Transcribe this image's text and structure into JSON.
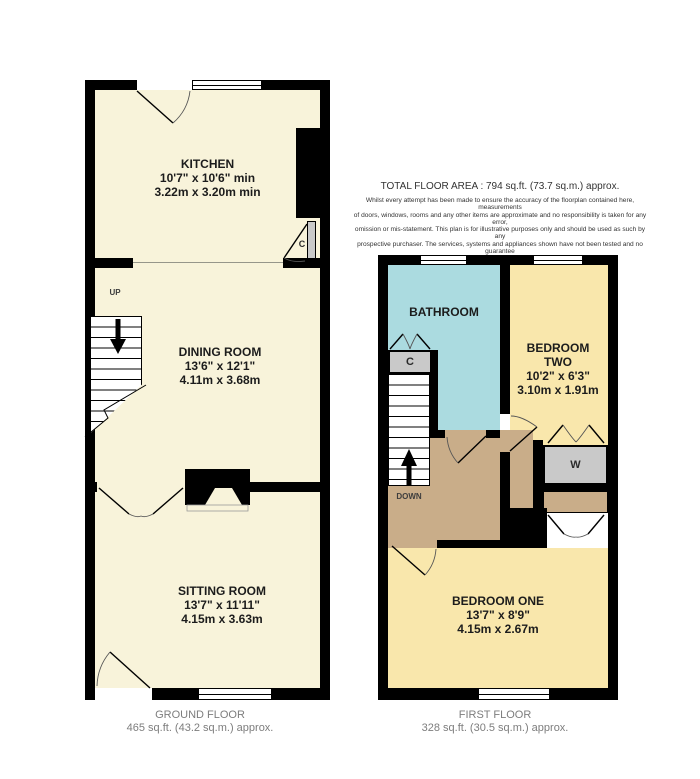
{
  "header": {
    "total_area": "TOTAL FLOOR AREA : 794 sq.ft. (73.7 sq.m.) approx.",
    "disclaimer_lines": [
      "Whilst every attempt has been made to ensure the accuracy of the floorplan contained here, measurements",
      "of doors, windows, rooms and any other items are approximate and no responsibility is taken for any error,",
      "omission or mis-statement. This plan is for illustrative purposes only and should be used as such by any",
      "prospective purchaser. The services, systems and appliances shown have not been tested and no guarantee",
      "as to their operability or efficiency can be given."
    ],
    "credit": "Made with Metropix ©2026"
  },
  "ground_floor": {
    "floor_label": "GROUND FLOOR",
    "floor_area": "465 sq.ft. (43.2 sq.m.) approx.",
    "stairs_direction": "UP",
    "cupboard": "C",
    "rooms": {
      "kitchen": {
        "name": "KITCHEN",
        "imperial": "10'7\"  x 10'6\" min",
        "metric": "3.22m  x 3.20m min"
      },
      "dining": {
        "name": "DINING ROOM",
        "imperial": "13'6\"  x 12'1\"",
        "metric": "4.11m  x 3.68m"
      },
      "sitting": {
        "name": "SITTING ROOM",
        "imperial": "13'7\"  x 11'11\"",
        "metric": "4.15m  x 3.63m"
      }
    }
  },
  "first_floor": {
    "floor_label": "FIRST FLOOR",
    "floor_area": "328 sq.ft. (30.5 sq.m.) approx.",
    "stairs_direction": "DOWN",
    "cupboard": "C",
    "wardrobe": "W",
    "rooms": {
      "bathroom": {
        "name": "BATHROOM"
      },
      "bedroom_two": {
        "name_line1": "BEDROOM",
        "name_line2": "TWO",
        "imperial": "10'2\"  x 6'3\"",
        "metric": "3.10m  x 1.91m"
      },
      "bedroom_one": {
        "name": "BEDROOM ONE",
        "imperial": "13'7\"  x 8'9\"",
        "metric": "4.15m  x 2.67m"
      }
    }
  },
  "colors": {
    "ground_room_fill": "#f8f3da",
    "bedroom_fill": "#f9e7ac",
    "bathroom_fill": "#abdbe0",
    "landing_fill": "#c9ad89",
    "cupboard_fill": "#c9c9c9",
    "wall": "#000000",
    "floor_label_text": "#7d7d7d"
  }
}
